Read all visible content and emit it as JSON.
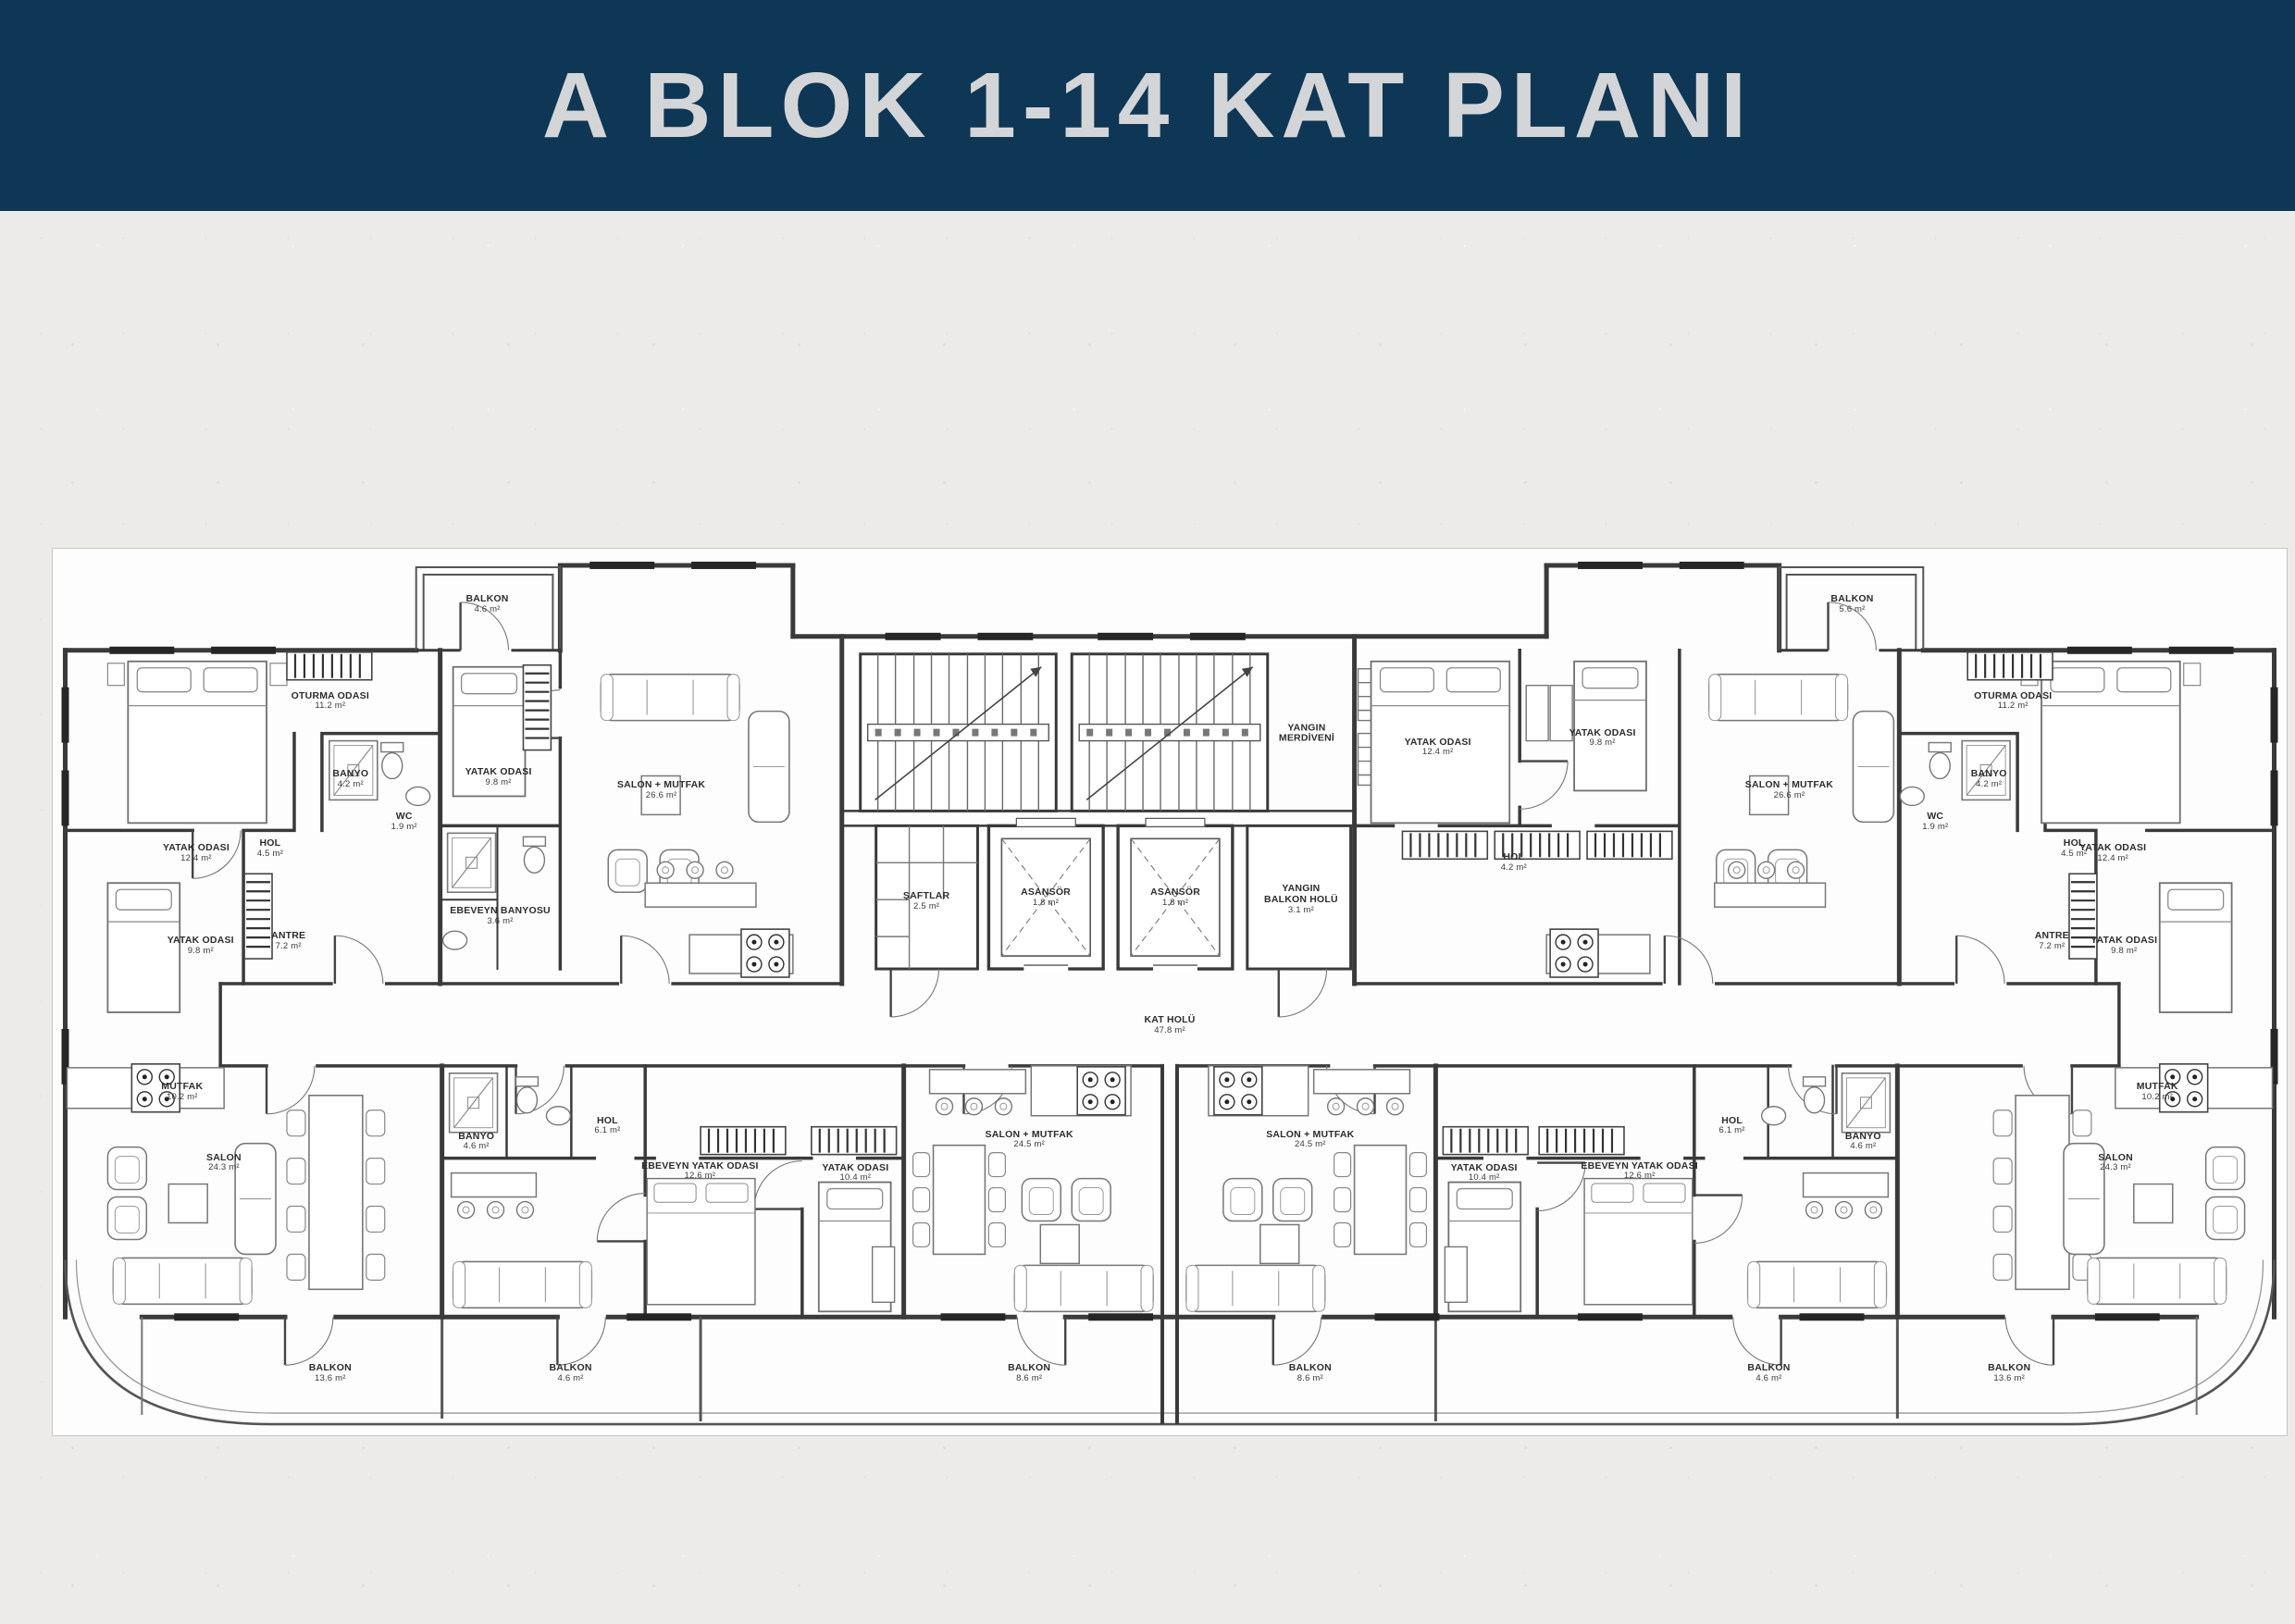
{
  "header": {
    "title": "A BLOK 1-14 KAT PLANI"
  },
  "colors": {
    "header_bg": "#0d3754",
    "header_text": "#d3d5d7",
    "page_bg": "#ecebe9",
    "plan_bg": "#fdfdfd",
    "line": "#3a3a3a"
  },
  "plan": {
    "rooms": [
      {
        "label": "BALKON",
        "area": "4.6 m²",
        "x": 19.45,
        "y": 6.25
      },
      {
        "label": "OTURMA ODASI",
        "area": "11.2 m²",
        "x": 12.42,
        "y": 17.19
      },
      {
        "label": "YATAK ODASI",
        "area": "12.4 m²",
        "x": 6.42,
        "y": 34.38
      },
      {
        "label": "YATAK ODASI",
        "area": "9.8 m²",
        "x": 6.62,
        "y": 44.79
      },
      {
        "label": "HOL",
        "area": "4.5 m²",
        "x": 9.73,
        "y": 33.85
      },
      {
        "label": "ANTRE",
        "area": "7.2 m²",
        "x": 10.55,
        "y": 44.27
      },
      {
        "label": "BANYO",
        "area": "4.2 m²",
        "x": 13.33,
        "y": 26.04
      },
      {
        "label": "WC",
        "area": "1.9 m²",
        "x": 15.73,
        "y": 30.83
      },
      {
        "label": "YATAK ODASI",
        "area": "9.8 m²",
        "x": 19.95,
        "y": 25.83
      },
      {
        "label": "SALON + MUTFAK",
        "area": "26.6 m²",
        "x": 27.24,
        "y": 27.29
      },
      {
        "label": "EBEVEYN BANYOSU",
        "area": "3.6 m²",
        "x": 20.03,
        "y": 41.46
      },
      {
        "label": "ŞAFTLAR",
        "area": "2.5 m²",
        "x": 39.11,
        "y": 39.79
      },
      {
        "label": "ASANSÖR",
        "area": "1.8 m²",
        "x": 44.45,
        "y": 39.38
      },
      {
        "label": "ASANSÖR",
        "area": "1.8 m²",
        "x": 50.25,
        "y": 39.38
      },
      {
        "label": "YANGIN",
        "label2": "MERDİVENİ",
        "x": 56.13,
        "y": 20.83
      },
      {
        "label": "YANGIN",
        "label2": "BALKON HOLÜ",
        "area": "3.1 m²",
        "x": 55.88,
        "y": 39.58
      },
      {
        "label": "KAT HOLÜ",
        "area": "47.8 m²",
        "x": 50.0,
        "y": 53.75
      },
      {
        "label": "YATAK ODASI",
        "area": "12.4 m²",
        "x": 62.0,
        "y": 22.4
      },
      {
        "label": "YATAK ODASI",
        "area": "9.8 m²",
        "x": 69.37,
        "y": 21.35
      },
      {
        "label": "HOL",
        "area": "4.2 m²",
        "x": 65.4,
        "y": 35.42
      },
      {
        "label": "SALON + MUTFAK",
        "area": "26.6 m²",
        "x": 77.73,
        "y": 27.29
      },
      {
        "label": "BALKON",
        "area": "5.6 m²",
        "x": 80.55,
        "y": 6.25
      },
      {
        "label": "YATAK ODASI",
        "area": "12.4 m²",
        "x": 92.22,
        "y": 34.38
      },
      {
        "label": "YATAK ODASI",
        "area": "9.8 m²",
        "x": 92.72,
        "y": 44.79
      },
      {
        "label": "OTURMA ODASI",
        "area": "11.2 m²",
        "x": 87.75,
        "y": 17.19
      },
      {
        "label": "HOL",
        "area": "4.5 m²",
        "x": 90.48,
        "y": 33.85
      },
      {
        "label": "ANTRE",
        "area": "7.2 m²",
        "x": 89.49,
        "y": 44.27
      },
      {
        "label": "BANYO",
        "area": "4.2 m²",
        "x": 86.67,
        "y": 26.04
      },
      {
        "label": "WC",
        "area": "1.9 m²",
        "x": 84.27,
        "y": 30.83
      },
      {
        "label": "MUTFAK",
        "area": "10.2 m²",
        "x": 5.79,
        "y": 61.25
      },
      {
        "label": "SALON",
        "area": "24.3 m²",
        "x": 7.66,
        "y": 69.27
      },
      {
        "label": "BALKON",
        "area": "13.6 m²",
        "x": 12.42,
        "y": 93.02
      },
      {
        "label": "BANYO",
        "area": "4.6 m²",
        "x": 18.96,
        "y": 66.88
      },
      {
        "label": "HOL",
        "area": "6.1 m²",
        "x": 24.83,
        "y": 65.1
      },
      {
        "label": "EBEVEYN YATAK ODASI",
        "area": "12.6 m²",
        "x": 28.97,
        "y": 70.21
      },
      {
        "label": "YATAK ODASI",
        "area": "10.4 m²",
        "x": 35.93,
        "y": 70.42
      },
      {
        "label": "SALON + MUTFAK",
        "area": "24.5 m²",
        "x": 43.71,
        "y": 66.67
      },
      {
        "label": "BALKON",
        "area": "8.6 m²",
        "x": 43.71,
        "y": 93.02
      },
      {
        "label": "SALON + MUTFAK",
        "area": "24.5 m²",
        "x": 56.29,
        "y": 66.67
      },
      {
        "label": "BALKON",
        "area": "8.6 m²",
        "x": 56.29,
        "y": 93.02
      },
      {
        "label": "BANYO",
        "area": "4.6 m²",
        "x": 81.04,
        "y": 66.88
      },
      {
        "label": "HOL",
        "area": "6.1 m²",
        "x": 75.17,
        "y": 65.1
      },
      {
        "label": "EBEVEYN YATAK ODASI",
        "area": "12.6 m²",
        "x": 71.03,
        "y": 70.21
      },
      {
        "label": "YATAK ODASI",
        "area": "10.4 m²",
        "x": 64.07,
        "y": 70.42
      },
      {
        "label": "SALON",
        "area": "24.3 m²",
        "x": 92.34,
        "y": 69.27
      },
      {
        "label": "MUTFAK",
        "area": "10.2 m²",
        "x": 94.21,
        "y": 61.25
      },
      {
        "label": "BALKON",
        "area": "13.6 m²",
        "x": 87.58,
        "y": 93.02
      },
      {
        "label": "BALKON",
        "area": "4.6 m²",
        "x": 23.18,
        "y": 93.02
      },
      {
        "label": "BALKON",
        "area": "4.6 m²",
        "x": 76.82,
        "y": 93.02
      }
    ]
  }
}
